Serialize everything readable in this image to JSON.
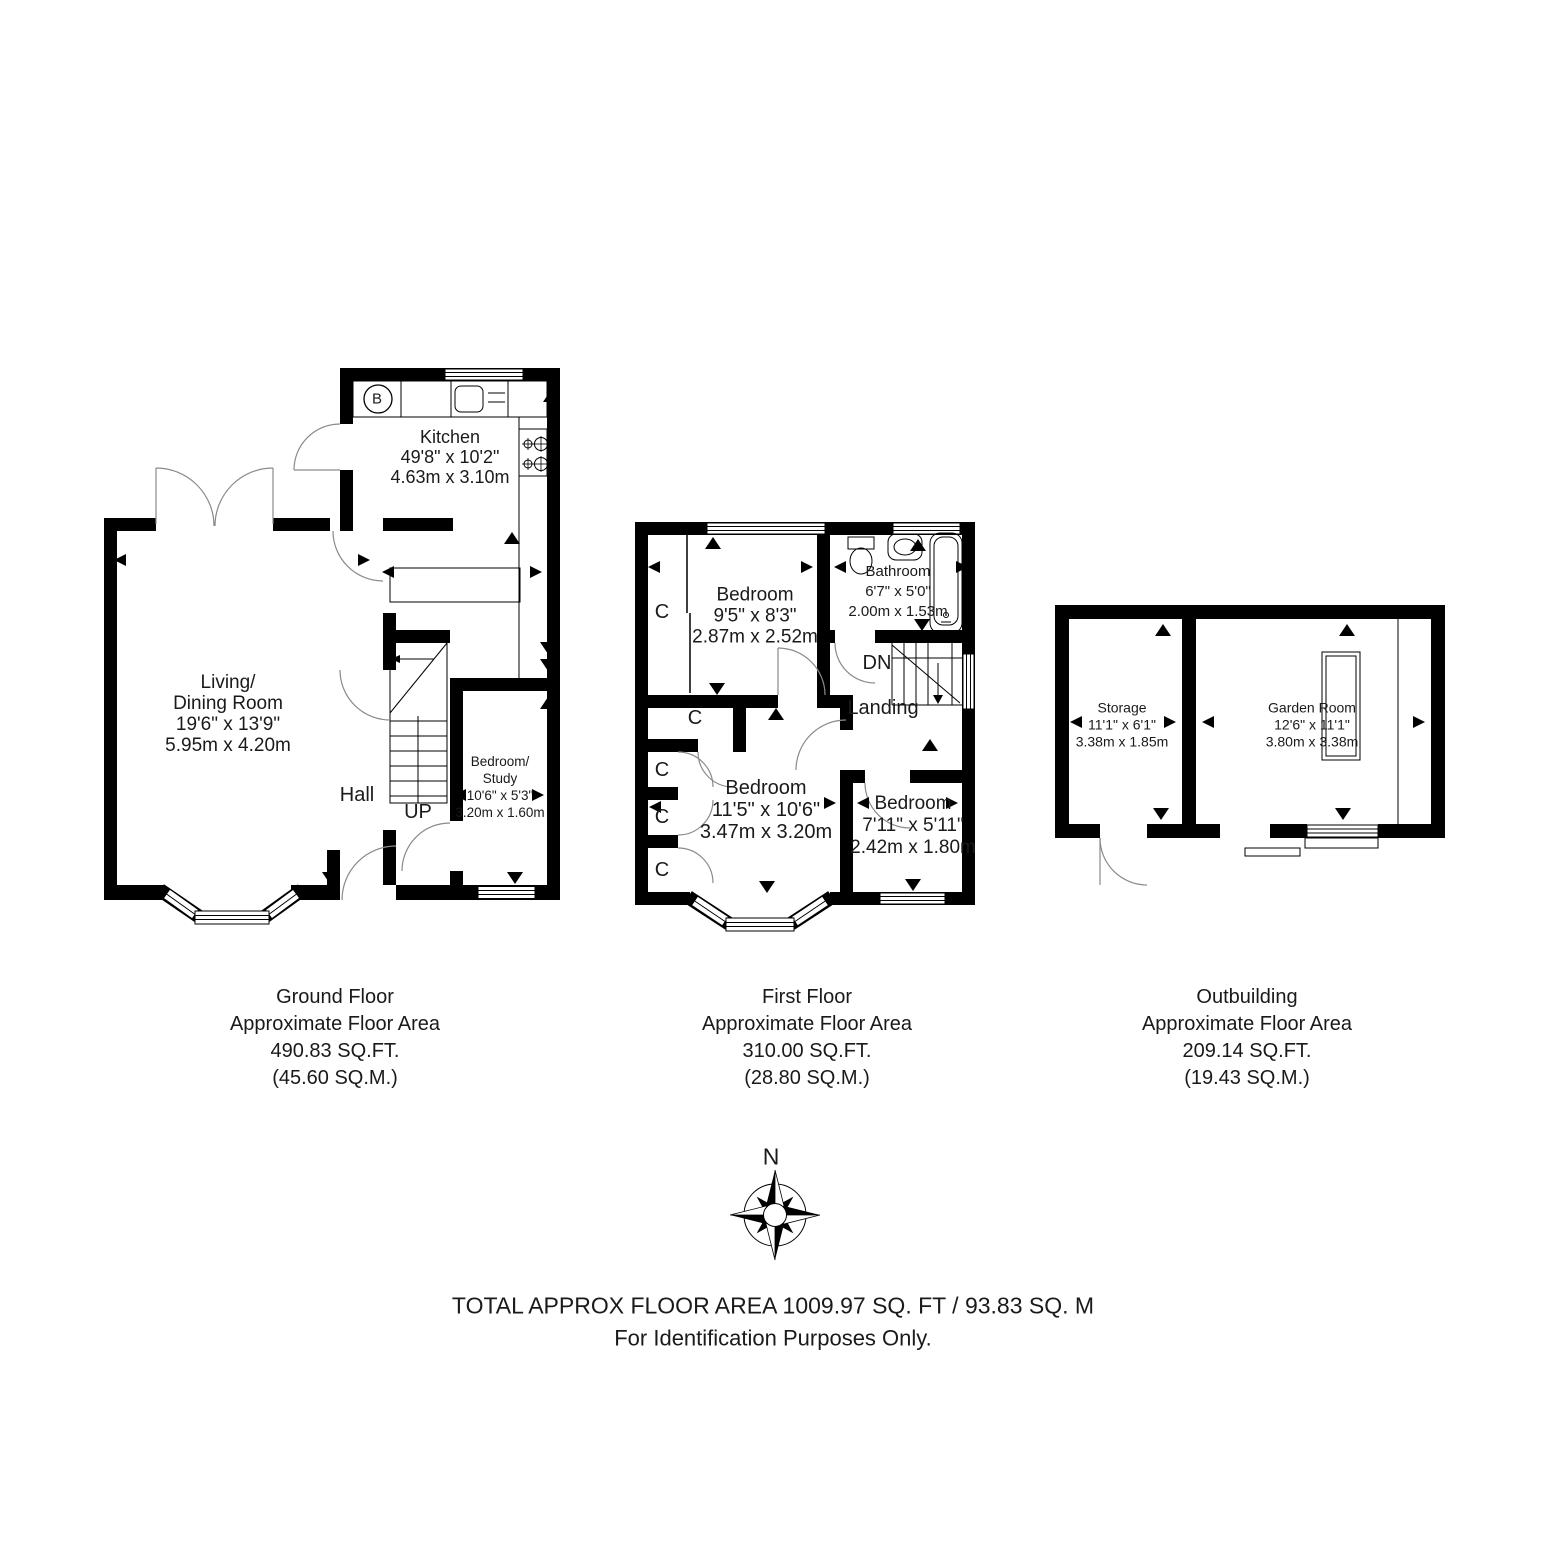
{
  "compass": {
    "north_label": "N"
  },
  "footer": {
    "total": "TOTAL APPROX FLOOR AREA 1009.97 SQ. FT / 93.83 SQ. M",
    "disclaimer": "For Identification Purposes Only."
  },
  "floors": {
    "ground": {
      "caption": {
        "floor_name": "Ground Floor",
        "area_label": "Approximate Floor Area",
        "area_sqft": "490.83 SQ.FT.",
        "area_sqm": "(45.60 SQ.M.)"
      },
      "rooms": {
        "kitchen": {
          "name": "Kitchen",
          "imperial": "49'8\" x 10'2\"",
          "metric": "4.63m x 3.10m"
        },
        "living_dining": {
          "name_line1": "Living/",
          "name_line2": "Dining Room",
          "imperial": "19'6\" x 13'9\"",
          "metric": "5.95m x 4.20m"
        },
        "hall": {
          "name": "Hall"
        },
        "stairs": {
          "direction": "UP"
        },
        "bedroom_study": {
          "name_line1": "Bedroom/",
          "name_line2": "Study",
          "imperial": "10'6\" x 5'3\"",
          "metric": "3.20m x 1.60m"
        },
        "boiler": {
          "label": "B"
        }
      }
    },
    "first": {
      "caption": {
        "floor_name": "First Floor",
        "area_label": "Approximate Floor Area",
        "area_sqft": "310.00 SQ.FT.",
        "area_sqm": "(28.80 SQ.M.)"
      },
      "rooms": {
        "bedroom_rear": {
          "name": "Bedroom",
          "imperial": "9'5\" x 8'3\"",
          "metric": "2.87m x 2.52m"
        },
        "bathroom": {
          "name": "Bathroom",
          "imperial": "6'7\" x 5'0\"",
          "metric": "2.00m x 1.53m"
        },
        "landing": {
          "name": "Landing"
        },
        "stairs": {
          "direction": "DN"
        },
        "bedroom_front": {
          "name": "Bedroom",
          "imperial": "11'5\" x 10'6\"",
          "metric": "3.47m x 3.20m"
        },
        "bedroom_side": {
          "name": "Bedroom",
          "imperial": "7'11\" x 5'11\"",
          "metric": "2.42m x 1.80m"
        },
        "closet": {
          "label": "C"
        }
      }
    },
    "outbuilding": {
      "caption": {
        "floor_name": "Outbuilding",
        "area_label": "Approximate Floor Area",
        "area_sqft": "209.14 SQ.FT.",
        "area_sqm": "(19.43 SQ.M.)"
      },
      "rooms": {
        "storage": {
          "name": "Storage",
          "imperial": "11'1\" x 6'1\"",
          "metric": "3.38m x 1.85m"
        },
        "garden_room": {
          "name": "Garden Room",
          "imperial": "12'6\" x 11'1\"",
          "metric": "3.80m x 3.38m"
        }
      }
    }
  }
}
